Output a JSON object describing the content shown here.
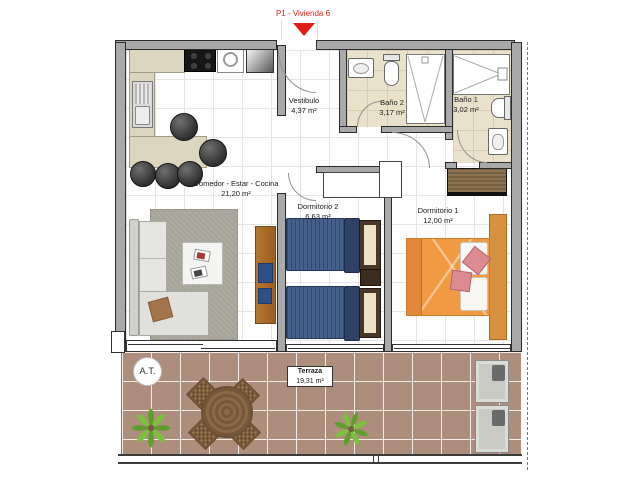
{
  "title": {
    "marker_label": "P1 - Vivienda 6"
  },
  "rooms": {
    "comedor": {
      "name": "Comedor - Estar - Cocina",
      "area": "21,20 m²"
    },
    "vestibulo": {
      "name": "Vestibulo",
      "area": "4,37 m²"
    },
    "bano2": {
      "name": "Baño 2",
      "area": "3,17 m²"
    },
    "bano1": {
      "name": "Baño 1",
      "area": "3,02 m²"
    },
    "dorm2": {
      "name": "Dormitorio 2",
      "area": "6,63 m²"
    },
    "dorm1": {
      "name": "Dormitorio 1",
      "area": "12,00 m²"
    },
    "terraza": {
      "name": "Terraza",
      "area": "19,31 m²"
    }
  },
  "annotations": {
    "at_label": "A.T."
  },
  "colors": {
    "marker-red": "#e01e17",
    "wall-gray": "#a9a9a9",
    "bath-tile": "#e9e1ca",
    "terrace-tile": "#ad8e7c",
    "bed-blue": "#45608a",
    "bed-orange": "#f09a44",
    "wood-brown": "#9a6f3a"
  }
}
